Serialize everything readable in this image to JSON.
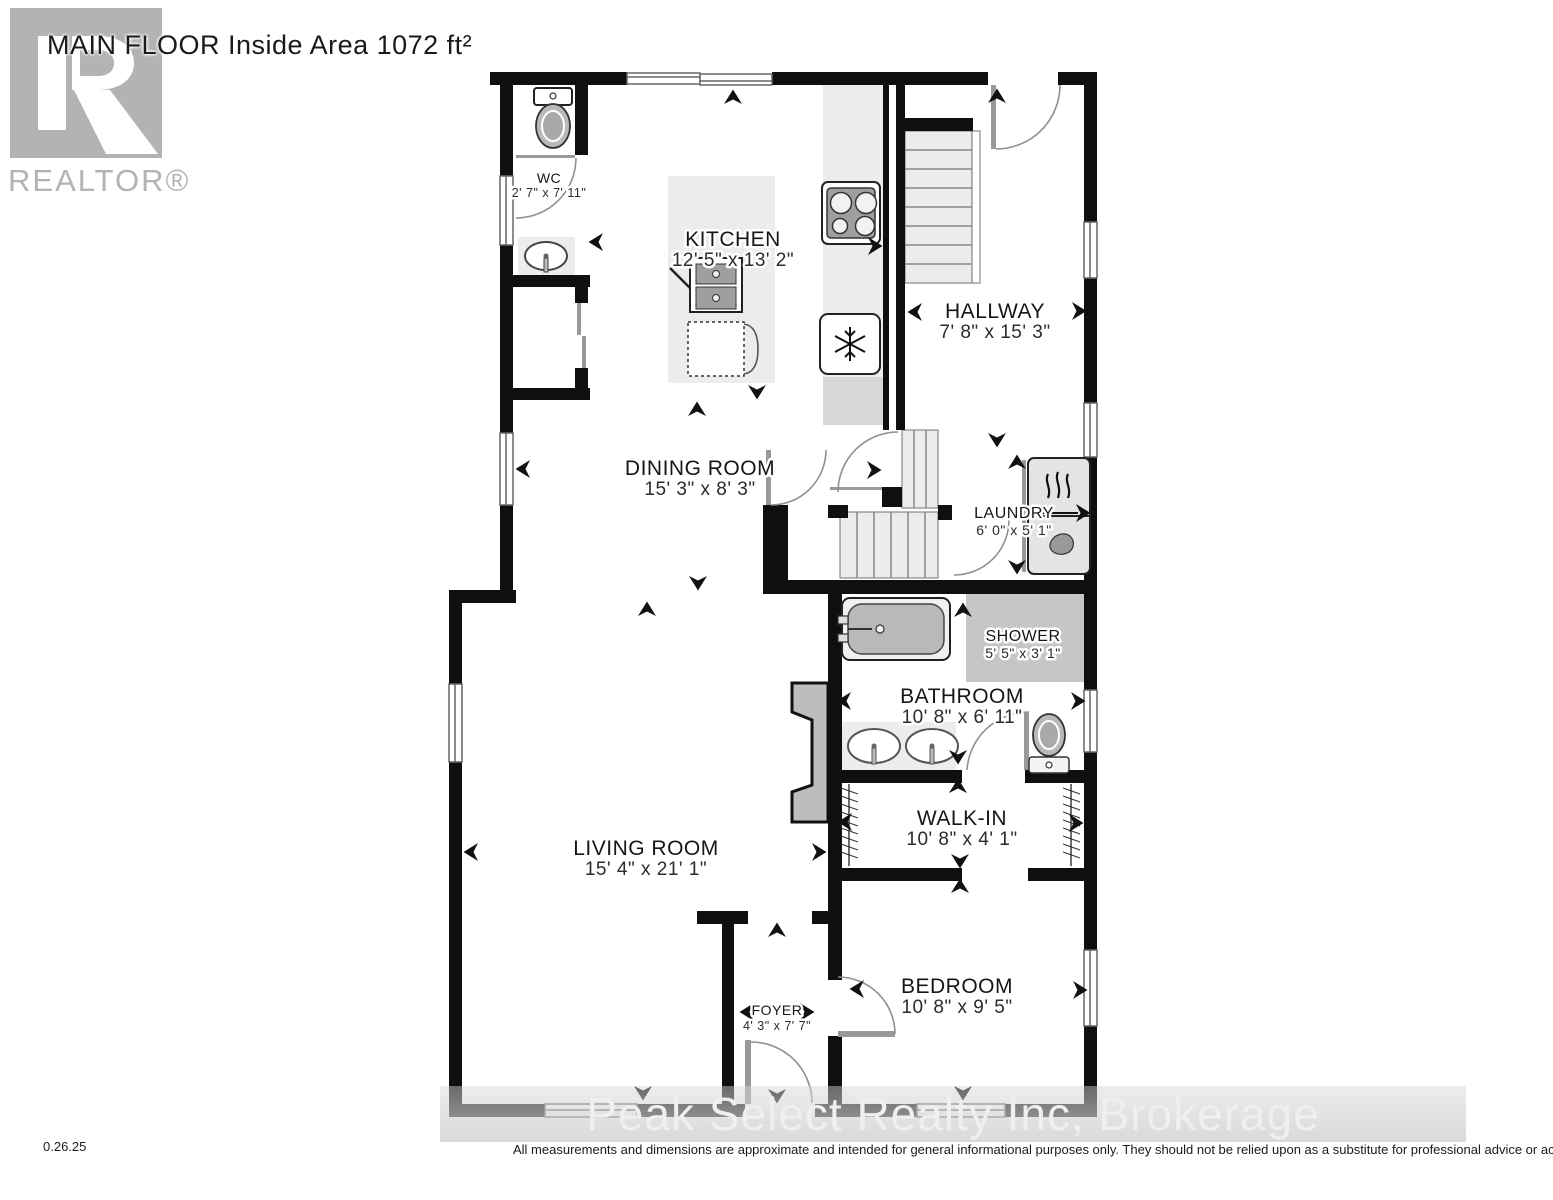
{
  "header": {
    "title": "MAIN FLOOR Inside Area 1072 ft²"
  },
  "logo": {
    "text": "REALTOR®"
  },
  "rooms": {
    "wc": {
      "name": "WC",
      "dims": "2' 7\" x 7' 11\""
    },
    "kitchen": {
      "name": "KITCHEN",
      "dims": "12' 5\" x 13' 2\""
    },
    "hallway": {
      "name": "HALLWAY",
      "dims": "7' 8\" x 15' 3\""
    },
    "dining": {
      "name": "DINING ROOM",
      "dims": "15' 3\" x 8' 3\""
    },
    "laundry": {
      "name": "LAUNDRY",
      "dims": "6' 0\" x 5' 1\""
    },
    "shower": {
      "name": "SHOWER",
      "dims": "5' 5\" x 3' 1\""
    },
    "bathroom": {
      "name": "BATHROOM",
      "dims": "10' 8\" x 6' 11\""
    },
    "walkin": {
      "name": "WALK-IN",
      "dims": "10' 8\" x 4' 1\""
    },
    "living": {
      "name": "LIVING ROOM",
      "dims": "15' 4\" x 21' 1\""
    },
    "bedroom": {
      "name": "BEDROOM",
      "dims": "10' 8\" x 9' 5\""
    },
    "foyer": {
      "name": "FOYER",
      "dims": "4' 3\" x 7' 7\""
    }
  },
  "watermark": {
    "text": "Peak Select Realty Inc, Brokerage"
  },
  "footer": {
    "date": "0.26.25",
    "disclaimer": "All measurements and dimensions are approximate and intended for general informational purposes only. They should not be relied upon as a substitute for professional advice or accurate surveying."
  },
  "colors": {
    "wall": "#0f0f0f",
    "counter": "#ececec",
    "fixture_gray": "#b9b9b9",
    "shower_floor": "#c6c6c6",
    "logo_gray": "#b3b3b3",
    "watermark_text": "#efefef"
  }
}
